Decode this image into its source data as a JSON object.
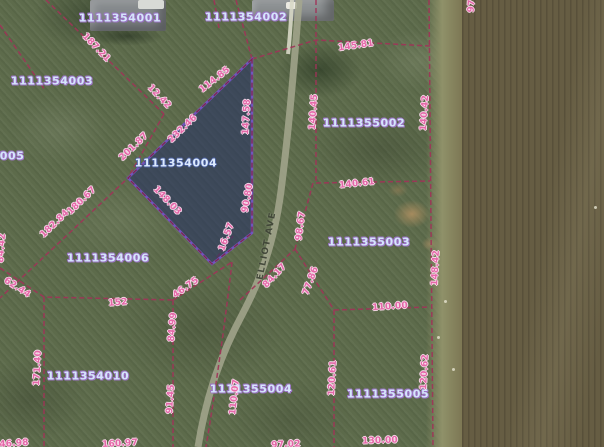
{
  "map": {
    "street": {
      "text": "ELLIOT AVE",
      "cx": 267,
      "cy": 246,
      "rot": -79
    },
    "selected_parcel_id": "1111354004",
    "parcel_labels": [
      {
        "text": "1111354001",
        "cx": 120,
        "cy": 18
      },
      {
        "text": "1111354002",
        "cx": 246,
        "cy": 17
      },
      {
        "text": "1111354003",
        "cx": 52,
        "cy": 81
      },
      {
        "text": "1111354004",
        "cx": 176,
        "cy": 163,
        "selected": true
      },
      {
        "text": "4005",
        "cx": 8,
        "cy": 156
      },
      {
        "text": "1111354006",
        "cx": 108,
        "cy": 258
      },
      {
        "text": "1111354010",
        "cx": 88,
        "cy": 376
      },
      {
        "text": "1111355002",
        "cx": 364,
        "cy": 123
      },
      {
        "text": "1111355003",
        "cx": 369,
        "cy": 242
      },
      {
        "text": "1111355004",
        "cx": 251,
        "cy": 389
      },
      {
        "text": "1111355005",
        "cx": 388,
        "cy": 394
      }
    ],
    "dimension_labels": [
      {
        "text": "187.21",
        "cx": 96,
        "cy": 48,
        "rot": 46
      },
      {
        "text": "12.42",
        "cx": 159,
        "cy": 97,
        "rot": 46
      },
      {
        "text": "114.85",
        "cx": 215,
        "cy": 80,
        "rot": -38
      },
      {
        "text": "147.58",
        "cx": 247,
        "cy": 117,
        "rot": -87
      },
      {
        "text": "232.46",
        "cx": 183,
        "cy": 129,
        "rot": -44
      },
      {
        "text": "201.87",
        "cx": 134,
        "cy": 147,
        "rot": -44
      },
      {
        "text": "145.81",
        "cx": 356,
        "cy": 46,
        "rot": -8
      },
      {
        "text": "140.45",
        "cx": 314,
        "cy": 112,
        "rot": -86
      },
      {
        "text": "140.42",
        "cx": 425,
        "cy": 113,
        "rot": -86
      },
      {
        "text": "140.61",
        "cx": 357,
        "cy": 184,
        "rot": -6
      },
      {
        "text": "148.03",
        "cx": 167,
        "cy": 201,
        "rot": 46
      },
      {
        "text": "90.80",
        "cx": 248,
        "cy": 198,
        "rot": -80
      },
      {
        "text": "180.67",
        "cx": 82,
        "cy": 201,
        "rot": -44
      },
      {
        "text": "182.84",
        "cx": 55,
        "cy": 224,
        "rot": -44
      },
      {
        "text": "16.57",
        "cx": 227,
        "cy": 237,
        "rot": -70
      },
      {
        "text": "98.67",
        "cx": 301,
        "cy": 226,
        "rot": -83
      },
      {
        "text": "84.42",
        "cx": 2,
        "cy": 248,
        "rot": -86
      },
      {
        "text": "148.42",
        "cx": 436,
        "cy": 268,
        "rot": -87
      },
      {
        "text": "84.17",
        "cx": 275,
        "cy": 276,
        "rot": -47
      },
      {
        "text": "77.86",
        "cx": 311,
        "cy": 281,
        "rot": -70
      },
      {
        "text": "62.44",
        "cx": 17,
        "cy": 288,
        "rot": 33
      },
      {
        "text": "46.75",
        "cx": 186,
        "cy": 288,
        "rot": -35
      },
      {
        "text": "152",
        "cx": 118,
        "cy": 303,
        "rot": -5
      },
      {
        "text": "110.00",
        "cx": 390,
        "cy": 307,
        "rot": -4
      },
      {
        "text": "84.99",
        "cx": 173,
        "cy": 327,
        "rot": -85
      },
      {
        "text": "171.40",
        "cx": 38,
        "cy": 368,
        "rot": -87
      },
      {
        "text": "120.61",
        "cx": 333,
        "cy": 378,
        "rot": -87
      },
      {
        "text": "120.62",
        "cx": 425,
        "cy": 372,
        "rot": -87
      },
      {
        "text": "91.45",
        "cx": 171,
        "cy": 399,
        "rot": -86
      },
      {
        "text": "110.07",
        "cx": 235,
        "cy": 397,
        "rot": -84
      },
      {
        "text": "97",
        "cx": 472,
        "cy": 6,
        "rot": -86
      },
      {
        "text": "46.98",
        "cx": 14,
        "cy": 444,
        "rot": -4
      },
      {
        "text": "160.97",
        "cx": 120,
        "cy": 444,
        "rot": -3
      },
      {
        "text": "97.02",
        "cx": 286,
        "cy": 445,
        "rot": -3
      },
      {
        "text": "130.00",
        "cx": 380,
        "cy": 441,
        "rot": -2
      }
    ],
    "colors": {
      "selected_parcel_fill": "#263064",
      "selected_parcel_border": "#7355c8",
      "boundary_line": "#a03358",
      "dimension_text": "#e468a8",
      "parcel_id_text": "#d5e6fb",
      "road": "#a4a78e"
    }
  }
}
